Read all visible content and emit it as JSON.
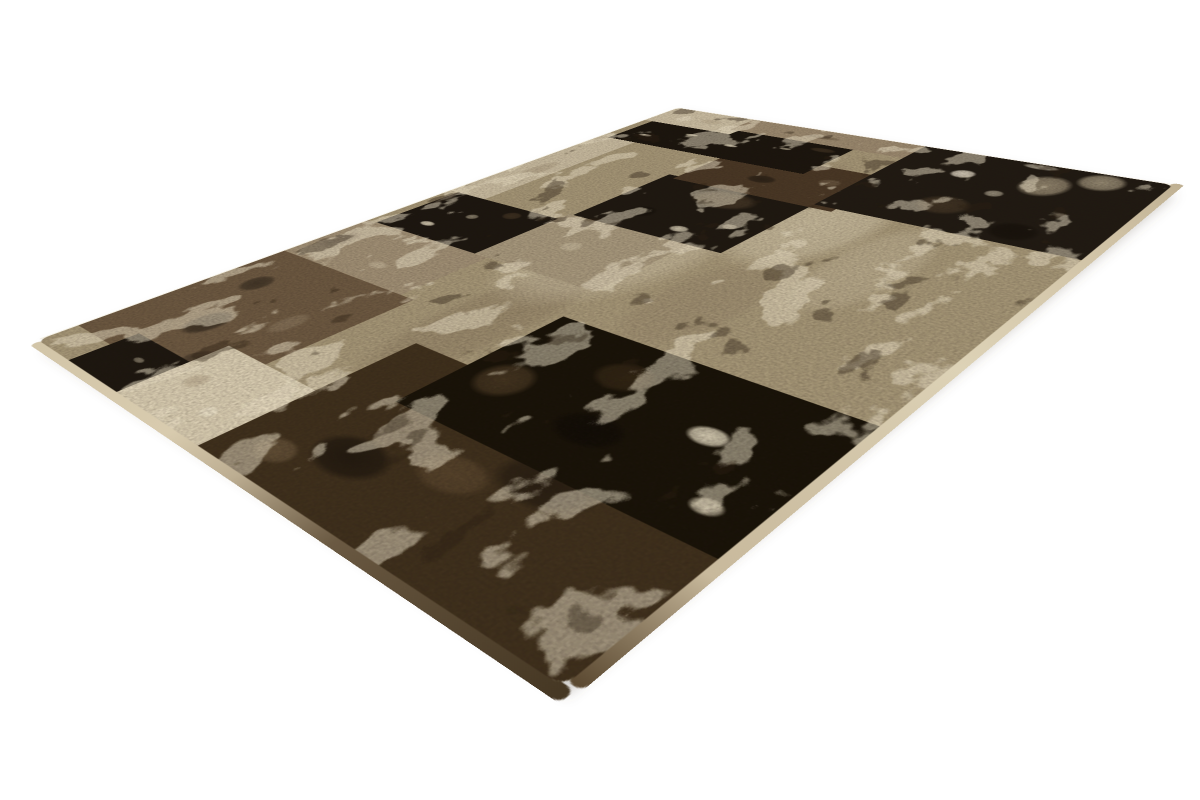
{
  "scene": {
    "width": 1200,
    "height": 800,
    "background_color": "#ffffff",
    "subject": "patchwork rug product photo, perspective view on white background"
  },
  "rug": {
    "corners": {
      "left": [
        38,
        340
      ],
      "top": [
        678,
        108
      ],
      "right": [
        1173,
        185
      ],
      "bottom": [
        563,
        687
      ]
    },
    "logical_size": {
      "w": 920,
      "h": 640
    },
    "palette": {
      "black": "#1a140d",
      "dark_brown": "#3f301d",
      "brown": "#6d5942",
      "taupe": "#9c8a70",
      "greige": "#a69778",
      "beige": "#c9bca1",
      "cream": "#d9cdb2",
      "distress_cream": "#e9dfc5"
    },
    "shadow": {
      "color": "rgba(100,90,72,0.28)",
      "offset": [
        4,
        9
      ],
      "blur": 6
    },
    "pile_edges": {
      "left_stops": [
        [
          0,
          "#d2c5a8"
        ],
        [
          38,
          "#d8cbae"
        ],
        [
          52,
          "#bdae92"
        ],
        [
          70,
          "#6a5942"
        ],
        [
          100,
          "#453723"
        ]
      ],
      "bottom_stops": [
        [
          0,
          "#5a4830"
        ],
        [
          12,
          "#c8b99c"
        ],
        [
          45,
          "#ddd2b6"
        ],
        [
          80,
          "#cfc1a4"
        ],
        [
          100,
          "#bfb092"
        ]
      ],
      "top_color": "#f0e9d7",
      "right_color": "#e8e0cc"
    },
    "texture": {
      "cream_blotch": {
        "freq": "0.013 0.02",
        "octaves": 4,
        "seed": 11,
        "gain": 1.4,
        "bias": -1.85,
        "color": "#e9dfc5",
        "opacity": 0.55
      },
      "dark_blotch": {
        "freq": "0.015 0.023",
        "octaves": 4,
        "seed": 29,
        "gain": 1.4,
        "bias": -2.1,
        "color": "#2f2415",
        "opacity": 0.4
      },
      "grain": {
        "freq": "0.4 0.4",
        "octaves": 2,
        "seed": 3,
        "gain": 0.9,
        "bias": -1.0,
        "color": "#241a10",
        "opacity": 0.25
      }
    },
    "patches": [
      {
        "name": "base-field",
        "u": 0,
        "v": 0,
        "w": 100,
        "h": 100,
        "color": "#a69778",
        "spots": [
          {
            "x": 52,
            "y": 44,
            "rx": 26,
            "ry": 20,
            "c": "#d9cdb2",
            "a": 0.5
          },
          {
            "x": 68,
            "y": 62,
            "rx": 20,
            "ry": 15,
            "c": "#e2d7bc",
            "a": 0.5
          },
          {
            "x": 30,
            "y": 46,
            "rx": 22,
            "ry": 10,
            "c": "#7e6c54",
            "a": 0.35
          },
          {
            "x": 44,
            "y": 66,
            "rx": 16,
            "ry": 10,
            "c": "#8a7860",
            "a": 0.3
          },
          {
            "x": 60,
            "y": 78,
            "rx": 18,
            "ry": 9,
            "c": "#cfc2a6",
            "a": 0.4
          },
          {
            "x": 80,
            "y": 50,
            "rx": 12,
            "ry": 9,
            "c": "#95836a",
            "a": 0.35
          }
        ]
      },
      {
        "name": "brown-upper-left",
        "u": 4,
        "v": 0,
        "w": 24,
        "h": 33,
        "color": "#6d5942",
        "spots": [
          {
            "x": 35,
            "y": 45,
            "rx": 16,
            "ry": 12,
            "c": "#241d15",
            "a": 0.7
          },
          {
            "x": 70,
            "y": 25,
            "rx": 12,
            "ry": 10,
            "c": "#241d15",
            "a": 0.6
          },
          {
            "x": 15,
            "y": 72,
            "rx": 10,
            "ry": 8,
            "c": "#2b221a",
            "a": 0.5
          },
          {
            "x": 8,
            "y": 80,
            "rx": 7,
            "ry": 6,
            "c": "#e3d8bf",
            "a": 0.85
          },
          {
            "x": 55,
            "y": 75,
            "rx": 14,
            "ry": 8,
            "c": "#9e8c72",
            "a": 0.4
          }
        ]
      },
      {
        "name": "taupe-upper",
        "u": 28,
        "v": 0,
        "w": 12,
        "h": 30,
        "color": "#a19076",
        "spots": [
          {
            "x": 50,
            "y": 12,
            "rx": 30,
            "ry": 10,
            "c": "#564636",
            "a": 0.5
          },
          {
            "x": 30,
            "y": 60,
            "rx": 10,
            "ry": 9,
            "c": "#d6c9ad",
            "a": 0.45
          }
        ]
      },
      {
        "name": "black-upper-left",
        "u": 40,
        "v": 2,
        "w": 13,
        "h": 25,
        "color": "#1c1610",
        "spots": [
          {
            "x": 25,
            "y": 32,
            "rx": 7,
            "ry": 9,
            "c": "#e8ddc3",
            "a": 0.9
          },
          {
            "x": 60,
            "y": 48,
            "rx": 8,
            "ry": 7,
            "c": "#d9cdb0",
            "a": 0.55
          },
          {
            "x": 82,
            "y": 70,
            "rx": 12,
            "ry": 10,
            "c": "#5a4730",
            "a": 0.5
          }
        ]
      },
      {
        "name": "beige-top-strip",
        "u": 53,
        "v": 0,
        "w": 31,
        "h": 9,
        "color": "#c9bca1",
        "spots": [
          {
            "x": 40,
            "y": 55,
            "rx": 18,
            "ry": 30,
            "c": "#8f7d63",
            "a": 0.35
          }
        ]
      },
      {
        "name": "greige-mid-left",
        "u": 40,
        "v": 27,
        "w": 15,
        "h": 25,
        "color": "#a8997e",
        "spots": [
          {
            "x": 50,
            "y": 42,
            "rx": 12,
            "ry": 10,
            "c": "#d8ccb0",
            "a": 0.45
          }
        ]
      },
      {
        "name": "black-center",
        "u": 55,
        "v": 28,
        "w": 18,
        "h": 30,
        "color": "#1e1811",
        "spots": [
          {
            "x": 76,
            "y": 55,
            "rx": 22,
            "ry": 28,
            "c": "#5a4833",
            "a": 0.6
          },
          {
            "x": 18,
            "y": 62,
            "rx": 7,
            "ry": 8,
            "c": "#e6dcc2",
            "a": 0.85
          },
          {
            "x": 38,
            "y": 82,
            "rx": 6,
            "ry": 6,
            "c": "#e0d4b8",
            "a": 0.6
          },
          {
            "x": 30,
            "y": 28,
            "rx": 14,
            "ry": 12,
            "c": "#120d08",
            "a": 0.6
          }
        ]
      },
      {
        "name": "darkbrown-right",
        "u": 72,
        "v": 30,
        "w": 14,
        "h": 32,
        "color": "#4a3826",
        "spots": [
          {
            "x": 40,
            "y": 42,
            "rx": 14,
            "ry": 12,
            "c": "#1b150e",
            "a": 0.65
          },
          {
            "x": 80,
            "y": 20,
            "rx": 6,
            "ry": 6,
            "c": "#e4d9be",
            "a": 0.7
          },
          {
            "x": 62,
            "y": 76,
            "rx": 12,
            "ry": 9,
            "c": "#8a775d",
            "a": 0.4
          }
        ]
      },
      {
        "name": "black-bar-top",
        "u": 82,
        "v": 2,
        "w": 12,
        "h": 46,
        "color": "#1b150e",
        "spots": [
          {
            "x": 30,
            "y": 12,
            "rx": 6,
            "ry": 5,
            "c": "#eae0c6",
            "a": 0.9
          },
          {
            "x": 58,
            "y": 30,
            "rx": 5,
            "ry": 5,
            "c": "#e5dabd",
            "a": 0.75
          },
          {
            "x": 45,
            "y": 54,
            "rx": 6,
            "ry": 5,
            "c": "#eadfc4",
            "a": 0.8
          },
          {
            "x": 66,
            "y": 76,
            "rx": 5,
            "ry": 4,
            "c": "#ddd1b4",
            "a": 0.6
          },
          {
            "x": 82,
            "y": 90,
            "rx": 10,
            "ry": 8,
            "c": "#55432e",
            "a": 0.5
          }
        ]
      },
      {
        "name": "beige-top-corner",
        "u": 92,
        "v": 0,
        "w": 8,
        "h": 22,
        "color": "#ccbfa4",
        "spots": [
          {
            "x": 50,
            "y": 60,
            "rx": 20,
            "ry": 16,
            "c": "#9d8b70",
            "a": 0.3
          }
        ]
      },
      {
        "name": "taupe-right-edge",
        "u": 94,
        "v": 20,
        "w": 6,
        "h": 38,
        "color": "#9c8a70",
        "spots": [
          {
            "x": 50,
            "y": 50,
            "rx": 18,
            "ry": 14,
            "c": "#4f3f2c",
            "a": 0.4
          }
        ]
      },
      {
        "name": "black-right-large",
        "u": 73,
        "v": 58,
        "w": 27,
        "h": 42,
        "color": "#201a13",
        "spots": [
          {
            "x": 72,
            "y": 62,
            "rx": 20,
            "ry": 13,
            "c": "#b7a88c",
            "a": 0.75
          },
          {
            "x": 88,
            "y": 78,
            "rx": 16,
            "ry": 12,
            "c": "#c5b79a",
            "a": 0.7
          },
          {
            "x": 70,
            "y": 30,
            "rx": 8,
            "ry": 7,
            "c": "#e8decb",
            "a": 0.9
          },
          {
            "x": 52,
            "y": 50,
            "rx": 6,
            "ry": 5,
            "c": "#e0d5bc",
            "a": 0.6
          },
          {
            "x": 28,
            "y": 40,
            "rx": 16,
            "ry": 14,
            "c": "#5d4a33",
            "a": 0.5
          },
          {
            "x": 96,
            "y": 52,
            "rx": 5,
            "ry": 10,
            "c": "#e6dcc6",
            "a": 0.65
          },
          {
            "x": 14,
            "y": 72,
            "rx": 14,
            "ry": 12,
            "c": "#110c07",
            "a": 0.6
          }
        ]
      },
      {
        "name": "black-left-edge",
        "u": 0,
        "v": 10,
        "w": 7,
        "h": 16,
        "color": "#1d1710",
        "spots": [
          {
            "x": 60,
            "y": 50,
            "rx": 8,
            "ry": 10,
            "c": "#d8ccb0",
            "a": 0.5
          }
        ]
      },
      {
        "name": "cream-left",
        "u": 0,
        "v": 24,
        "w": 11,
        "h": 20,
        "color": "#d9cdb2",
        "spots": [
          {
            "x": 50,
            "y": 28,
            "rx": 16,
            "ry": 12,
            "c": "#a08e74",
            "a": 0.4
          },
          {
            "x": 30,
            "y": 70,
            "rx": 10,
            "ry": 10,
            "c": "#ece3cc",
            "a": 0.6
          }
        ]
      },
      {
        "name": "darkbrown-bottom",
        "u": 0,
        "v": 44,
        "w": 22,
        "h": 56,
        "color": "#3f301d",
        "spots": [
          {
            "x": 30,
            "y": 28,
            "rx": 16,
            "ry": 14,
            "c": "#16100a",
            "a": 0.7
          },
          {
            "x": 60,
            "y": 64,
            "rx": 18,
            "ry": 16,
            "c": "#1a130c",
            "a": 0.6
          },
          {
            "x": 16,
            "y": 14,
            "rx": 10,
            "ry": 8,
            "c": "#8a7355",
            "a": 0.45
          },
          {
            "x": 72,
            "y": 86,
            "rx": 8,
            "ry": 7,
            "c": "#e7ddc3",
            "a": 0.8
          },
          {
            "x": 45,
            "y": 48,
            "rx": 14,
            "ry": 12,
            "c": "#6b5439",
            "a": 0.5
          }
        ]
      },
      {
        "name": "black-bottom",
        "u": 14,
        "v": 54,
        "w": 20,
        "h": 46,
        "color": "#181208",
        "spots": [
          {
            "x": 40,
            "y": 14,
            "rx": 20,
            "ry": 12,
            "c": "#5f4a30",
            "a": 0.6
          },
          {
            "x": 72,
            "y": 38,
            "rx": 16,
            "ry": 12,
            "c": "#4a3820",
            "a": 0.5
          },
          {
            "x": 56,
            "y": 72,
            "rx": 9,
            "ry": 8,
            "c": "#eae0c6",
            "a": 0.9
          },
          {
            "x": 20,
            "y": 88,
            "rx": 7,
            "ry": 6,
            "c": "#e3d8bd",
            "a": 0.7
          },
          {
            "x": 32,
            "y": 48,
            "rx": 16,
            "ry": 14,
            "c": "#0d0905",
            "a": 0.7
          }
        ]
      }
    ]
  }
}
